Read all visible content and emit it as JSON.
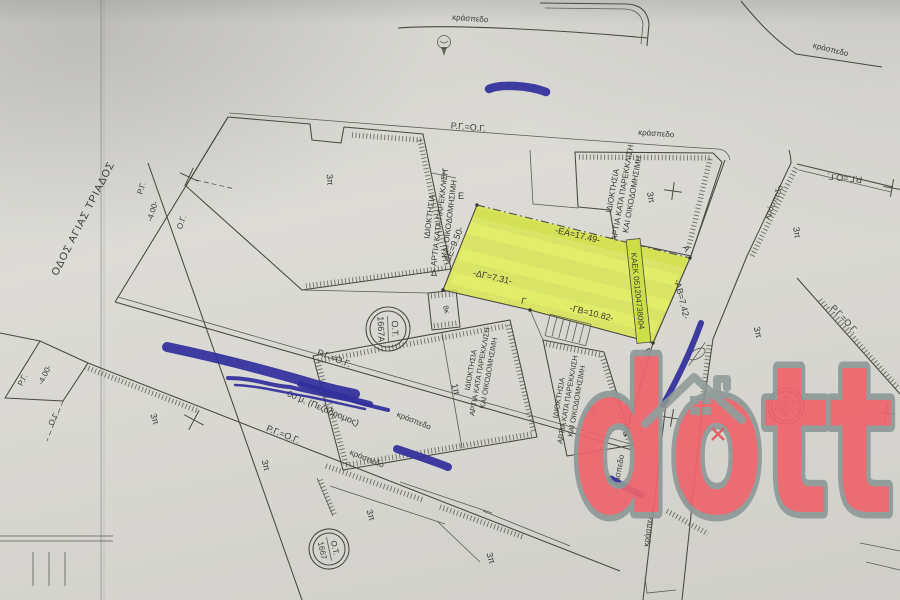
{
  "map": {
    "street_name": "ΟΔΟΣ ΑΓΙΑΣ ΤΡΙΑΔΟΣ",
    "pedestrian_note": "00 μ. (Πεζόδρομος)",
    "curb": "κράσπεδο",
    "alignment": "Ρ.Γ.=Ο.Γ.",
    "rg": "Ρ.Γ.",
    "og": "Ο.Γ.",
    "dim_4m": "-4.00-",
    "floors_3": "3π",
    "floors_1": "1π",
    "aux_8k": "8κ",
    "property_note": {
      "l1": "ΙΔΙΟΚΤΗΣΙΑ",
      "l2": "ΑΡΤΙΑ ΚΑΤΑ ΠΑΡΕΚΚΛΙΣΗ",
      "l3": "ΚΑΙ ΟΙΚΟΔΟΜΗΣΙΜΗ"
    },
    "blocks": {
      "prefix": "Ο.Τ.",
      "b1667a": "1667Α",
      "b1666": "1666",
      "b1667": "1667"
    },
    "parcel": {
      "kaek": "ΚΑΕΚ 051204738004",
      "vertex_a": "Α",
      "vertex_b": "Β",
      "vertex_g": "Γ",
      "vertex_d": "Δ",
      "vertex_e": "Ε",
      "edge_ea": "-ΕΑ=17.49-",
      "edge_ab": "-ΑΒ=7.42-",
      "edge_gb": "-ΓΒ=10.82-",
      "edge_dg": "-ΔΓ=7.31-",
      "edge_de": "-ΔΕ=9.50-",
      "highlight_color": "#d9e64f"
    },
    "watermark": {
      "text": "dott",
      "fill_color": "#ee646b",
      "outline_color": "#8d9998"
    },
    "colors": {
      "ink": "#44443e",
      "pen_blue": "#322f9c",
      "paper": "#d7d6d1"
    }
  }
}
